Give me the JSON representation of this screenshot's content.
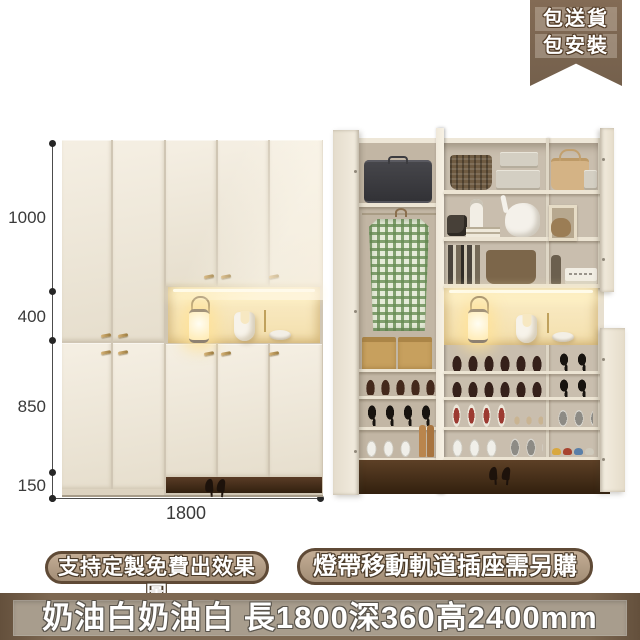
{
  "badge": {
    "lines": [
      "包送貨",
      "包安裝"
    ]
  },
  "dimensions": {
    "top": "1000",
    "middle": "400",
    "lower": "850",
    "base": "150",
    "width": "1800"
  },
  "tags": {
    "left": "支持定製免費出效果圖",
    "right": "燈帶移動軌道插座需另購"
  },
  "footer": {
    "text": "奶油白奶油白 長1800深360高2400mm"
  },
  "colors": {
    "ribbon_brown": "#7a6450",
    "bubble_fill": "#b49e86",
    "bubble_border": "#5f4a36",
    "footer_bg": "#7d6852",
    "footer_panel": "#a89d8d",
    "cabinet_cream": "#efe8da",
    "niche_glow": "#f8ecc9",
    "floor_brown": "#40291b",
    "shirt_green": "#8fae7e"
  }
}
